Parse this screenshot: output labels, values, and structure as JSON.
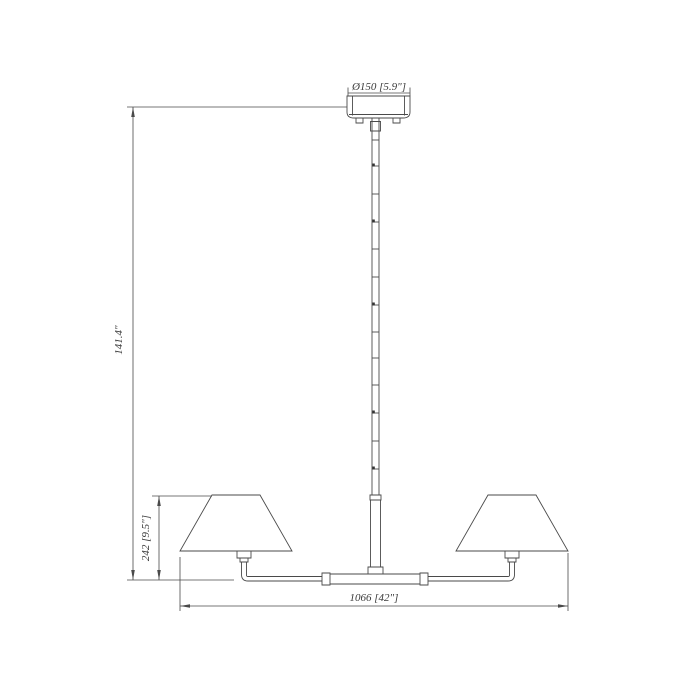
{
  "drawing": {
    "type": "technical-dimension-drawing",
    "subject": "two-light linear chandelier with conical empire shades, center hanging rod and round ceiling canopy",
    "colors": {
      "background": "#ffffff",
      "line": "#4a4a4a",
      "text": "#3a3a3a"
    },
    "labels": {
      "canopy_diameter": "Ø150 [5.9\"]",
      "overall_height": "141.4\"",
      "body_height": "242 [9.5\"]",
      "overall_width": "1066 [42\"]"
    },
    "parts": [
      "ceiling canopy",
      "hanging rod with joint connectors",
      "center arm tube with end collars",
      "left lamp shade",
      "right lamp shade",
      "left socket cup",
      "right socket cup"
    ]
  }
}
